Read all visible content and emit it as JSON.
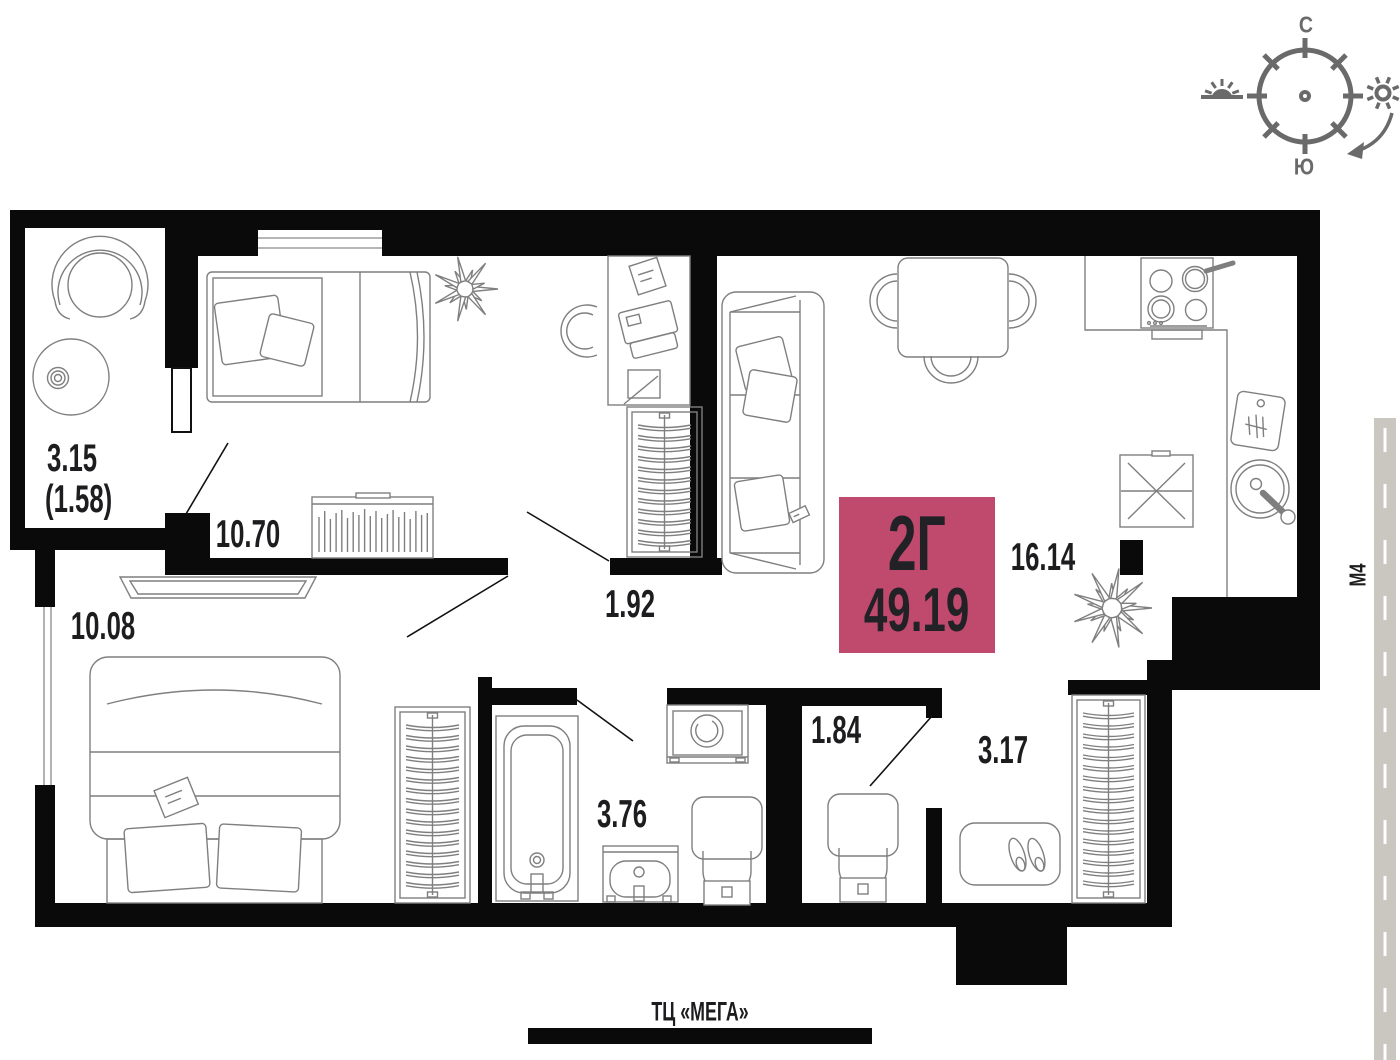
{
  "compass": {
    "north": "С",
    "south": "Ю"
  },
  "plan_badge": {
    "unit_type": "2Г",
    "total_area": "49.19"
  },
  "rooms": {
    "balcony": {
      "area": "3.15",
      "reduced_area": "(1.58)"
    },
    "bedroom_top": {
      "area": "10.70"
    },
    "bedroom_left": {
      "area": "10.08"
    },
    "hallway": {
      "area": "1.92"
    },
    "kitchen_living": {
      "area": "16.14"
    },
    "bathroom": {
      "area": "3.76"
    },
    "wc": {
      "area": "1.84"
    },
    "entry_hall": {
      "area": "3.17"
    }
  },
  "landmarks": {
    "highway": "М4",
    "mall": "ТЦ «МЕГА»"
  },
  "icons": {
    "compass_rose": "compass-rose-icon",
    "sunrise": "sunrise-icon",
    "sun": "sun-icon"
  },
  "colors": {
    "badge": "#bf4a6d",
    "compass": "#6a6a6a",
    "road": "#cac6c0",
    "wall": "#0a0a0a",
    "furniture": "#7f7f7f"
  }
}
